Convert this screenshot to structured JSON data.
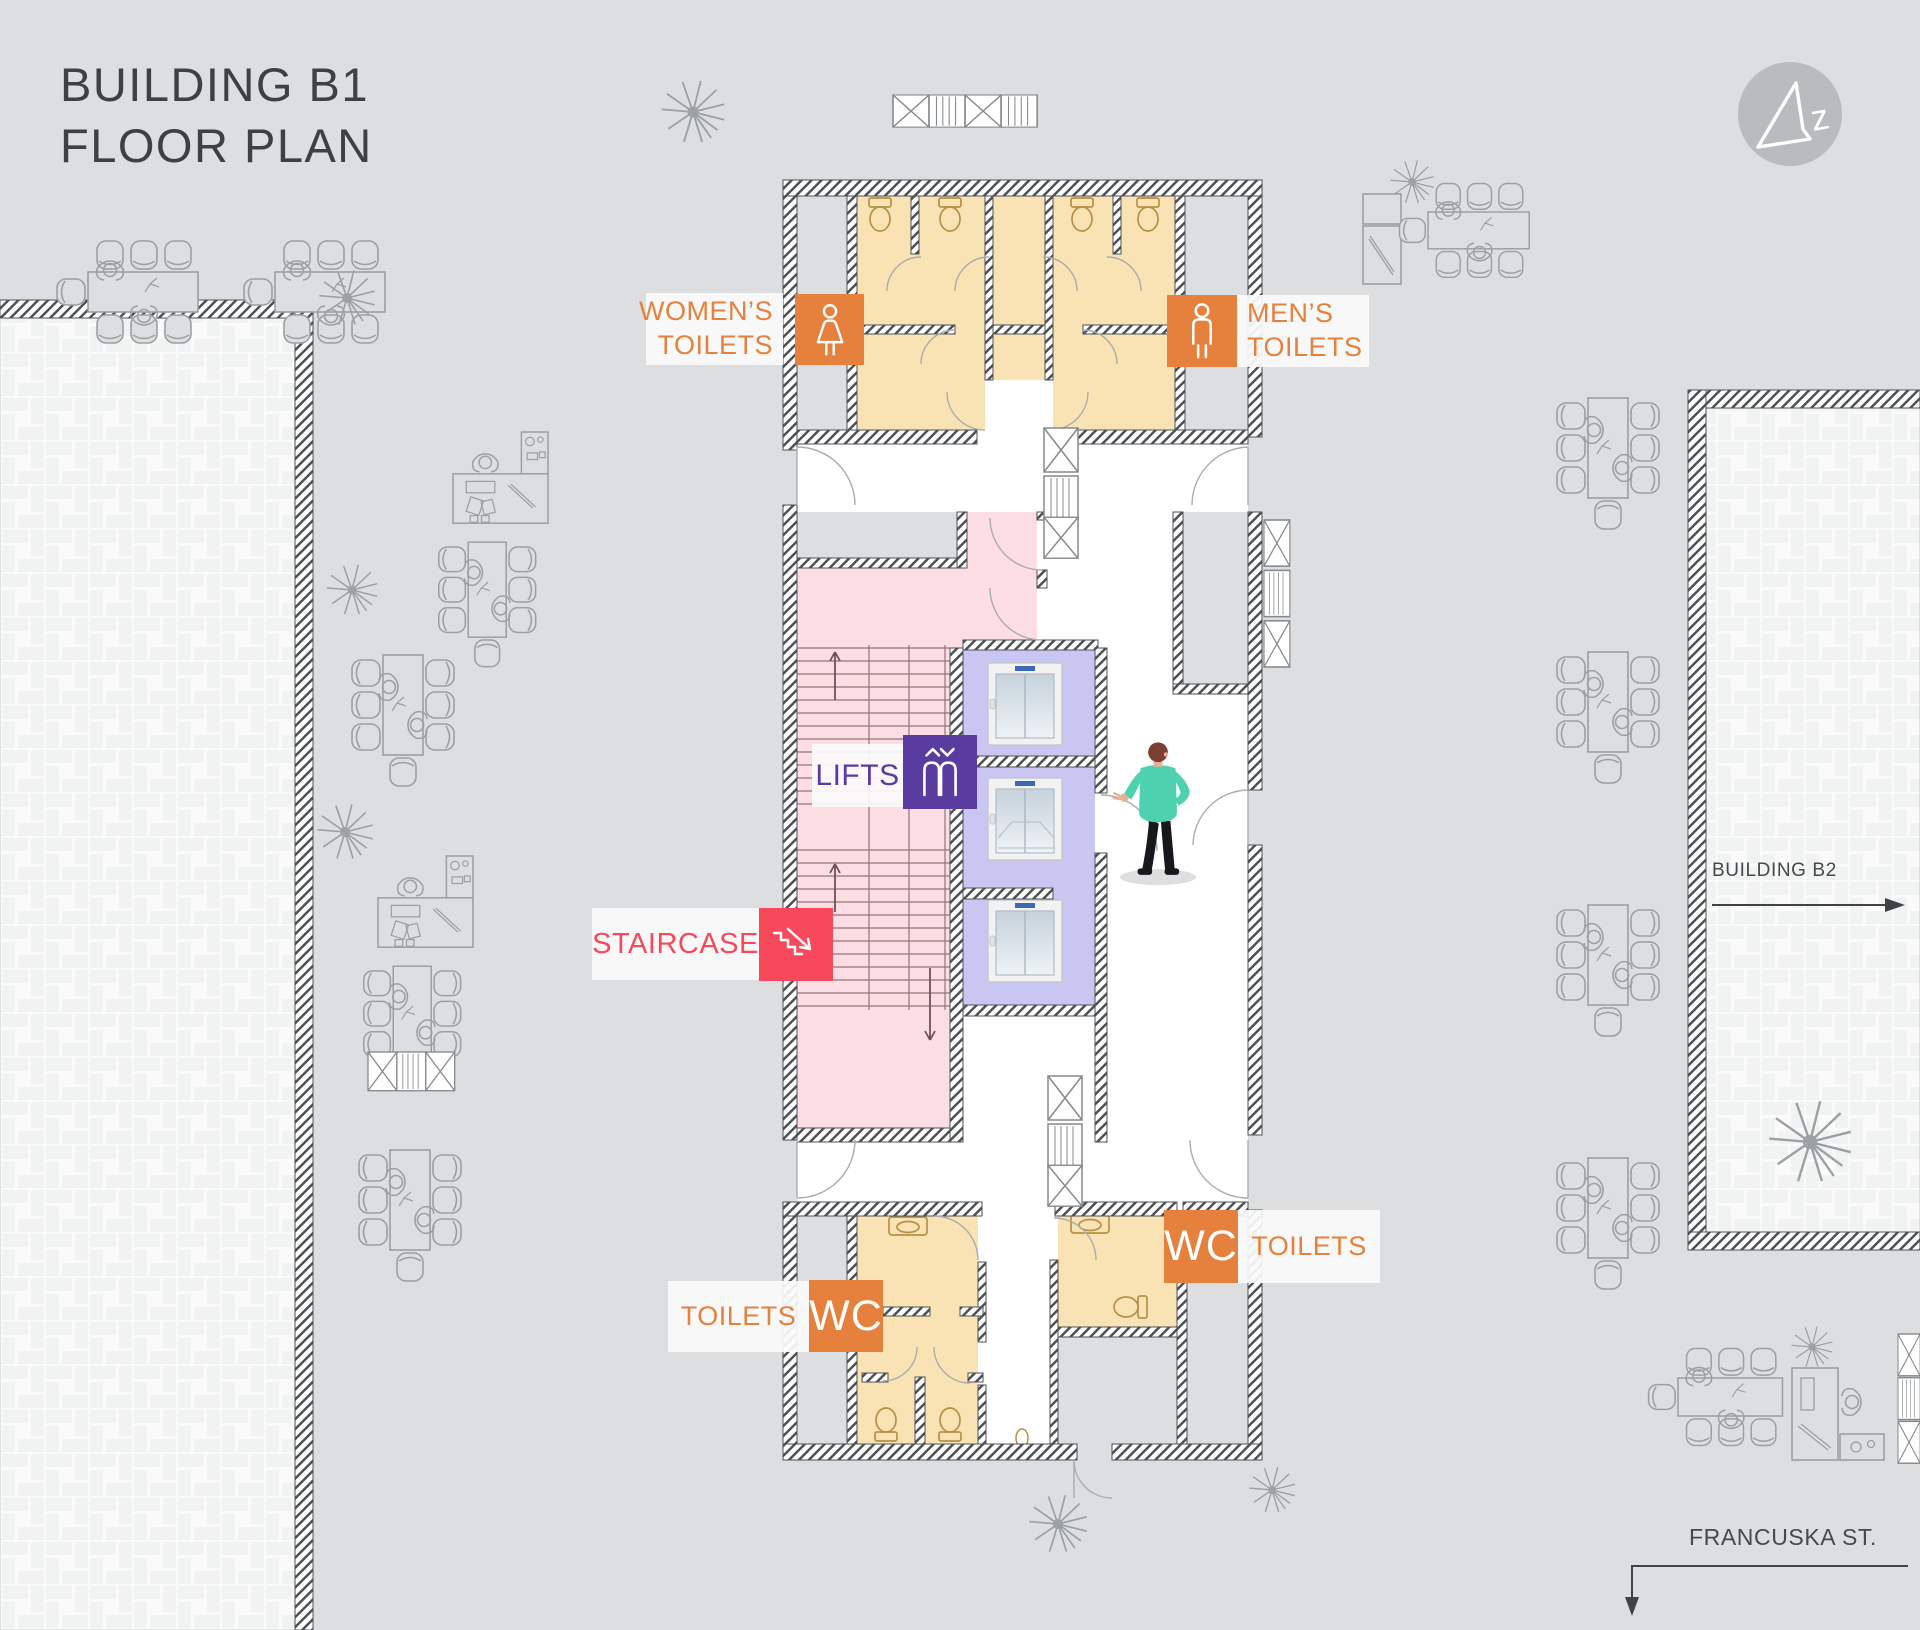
{
  "title": {
    "line1": "BUILDING B1",
    "line2": "FLOOR PLAN"
  },
  "plan_labels": {
    "womens_toilets": {
      "line1": "WOMEN’S",
      "line2": "TOILETS"
    },
    "mens_toilets": {
      "line1": "MEN’S",
      "line2": "TOILETS"
    },
    "lifts": {
      "text": "LIFTS"
    },
    "staircase": {
      "text": "STAIRCASE"
    },
    "toilets_bottom_left": {
      "text": "TOILETS",
      "badge": "WC"
    },
    "toilets_bottom_right": {
      "text": "TOILETS",
      "badge": "WC"
    }
  },
  "annotations": {
    "building_b2": "BUILDING B2",
    "street": "FRANCUSKA ST.",
    "compass_letter": "z"
  },
  "icons": [
    "north-compass-icon",
    "woman-icon",
    "man-icon",
    "lift-icon",
    "stairs-down-icon"
  ],
  "colors": {
    "background": "#dcdee0",
    "accent_orange": "#e5813c",
    "accent_purple": "#5a3b9f",
    "accent_red": "#f6495c",
    "room_tan": "#f9e2b4",
    "room_pink": "#fbdde3",
    "room_lavender": "#c9c6f1",
    "wall": "#4e5256",
    "paving": "#fafafa",
    "person_shirt": "#4ed1ae"
  }
}
